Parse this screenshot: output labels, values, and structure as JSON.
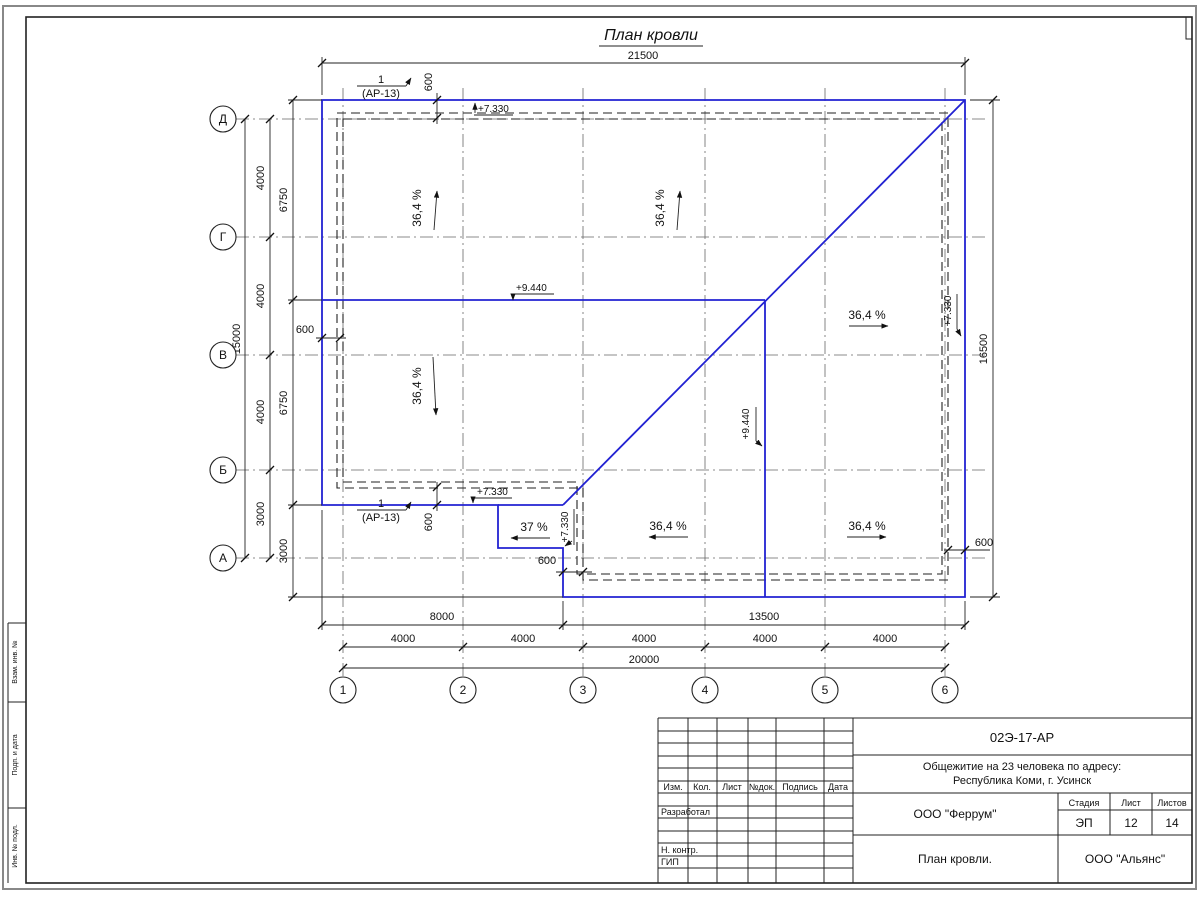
{
  "sheet_title": "План кровли",
  "axes": {
    "rows": [
      "Д",
      "Г",
      "В",
      "Б",
      "А"
    ],
    "cols": [
      "1",
      "2",
      "3",
      "4",
      "5",
      "6"
    ]
  },
  "dims": {
    "top_overall": "21500",
    "right_overall": "16500",
    "left_overall": "15000",
    "left_chain": [
      "4000",
      "4000",
      "4000",
      "3000"
    ],
    "left_inner_chain": [
      "6750",
      "6750",
      "3000"
    ],
    "bottom_spans": [
      "8000",
      "13500"
    ],
    "bottom_axis": [
      "4000",
      "4000",
      "4000",
      "4000",
      "4000"
    ],
    "bottom_overall": "20000",
    "overhang": "600"
  },
  "elevations": {
    "eave": "+7.330",
    "ridge": "+9.440"
  },
  "slopes": {
    "main": "36,4 %",
    "canopy": "37 %"
  },
  "callout": {
    "num": "1",
    "ref": "(АР-13)"
  },
  "side_stamp": [
    "Взам. инв. №",
    "Подп. и дата",
    "Инв. № подл."
  ],
  "title_block": {
    "doc_number": "02Э-17-АР",
    "object_line1": "Общежитие на 23 человека по адресу:",
    "object_line2": "Республика Коми, г. Усинск",
    "designer_org": "ООО \"Феррум\"",
    "drawing_title": "План кровли.",
    "contractor_org": "ООО \"Альянс\"",
    "stage_label": "Стадия",
    "sheet_label": "Лист",
    "sheets_label": "Листов",
    "stage": "ЭП",
    "sheet_no": "12",
    "sheets_total": "14",
    "columns": [
      "Изм.",
      "Кол.",
      "Лист",
      "№док.",
      "Подпись",
      "Дата"
    ],
    "roles": [
      "Разработал",
      "Н. контр.",
      "ГИП"
    ]
  }
}
